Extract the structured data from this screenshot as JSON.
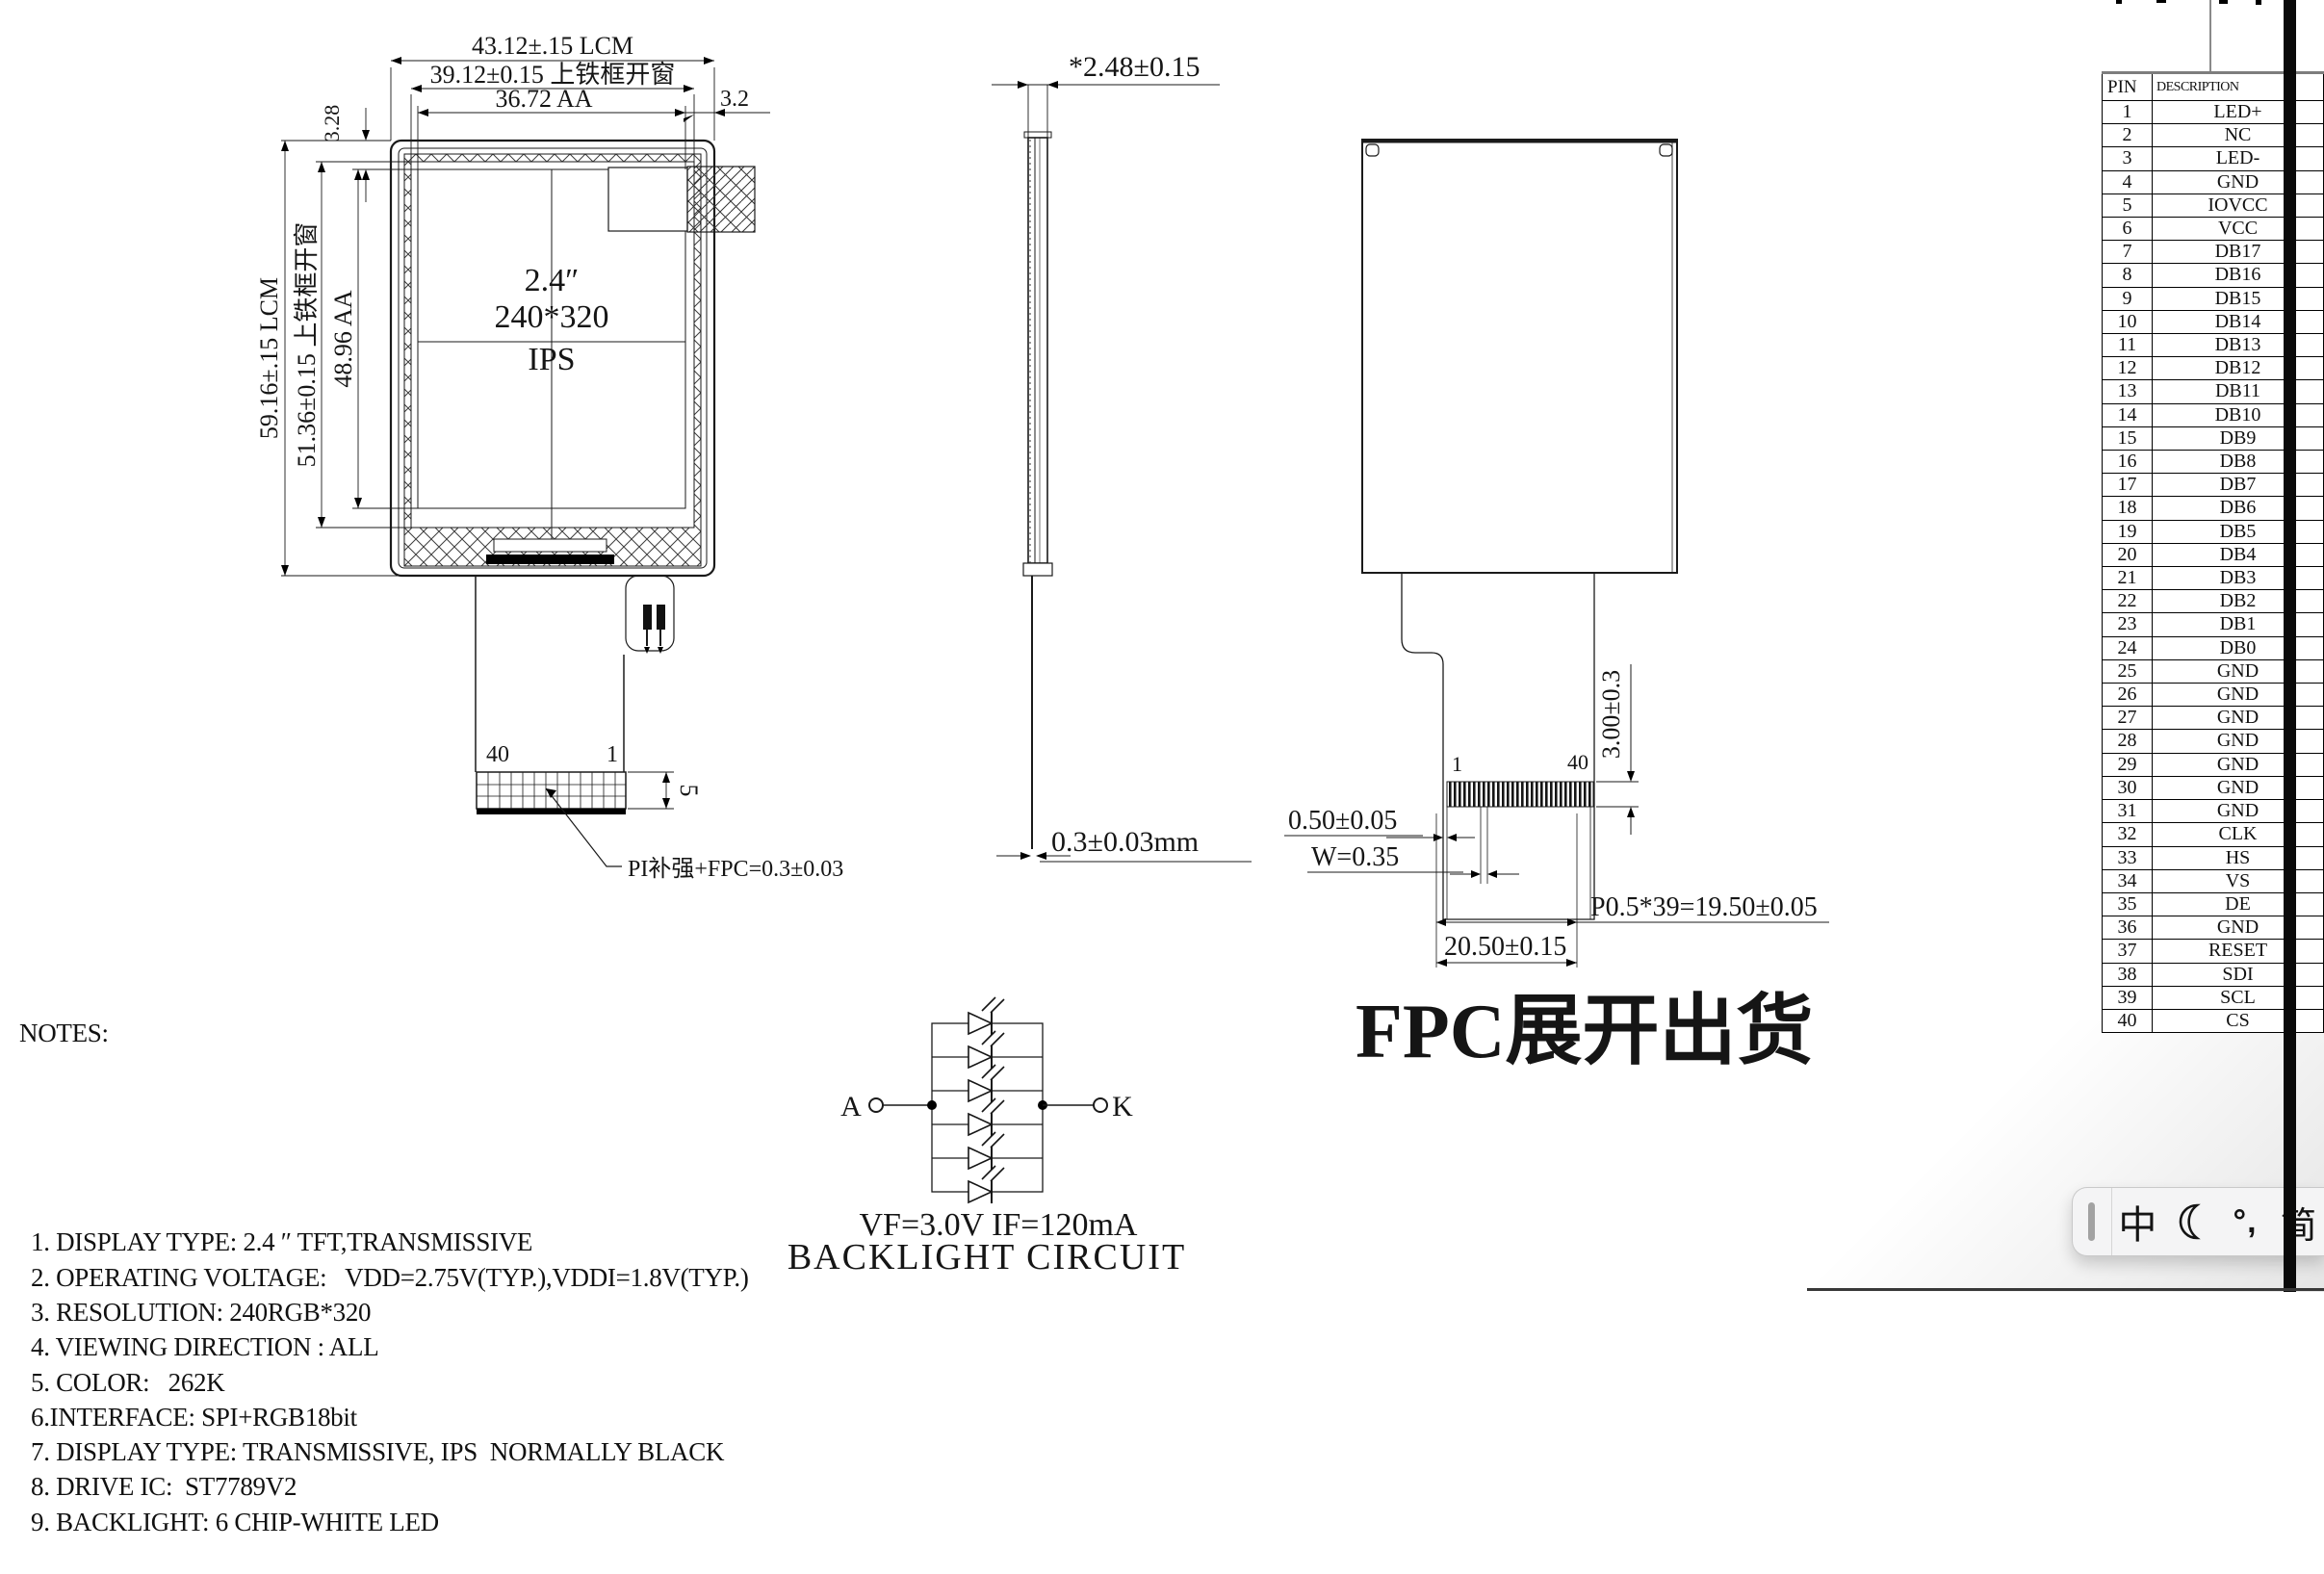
{
  "front_view": {
    "center_line1": "2.4″",
    "center_line2": "240*320",
    "center_line3": "IPS",
    "dim_width_lcm": "43.12±.15 LCM",
    "dim_width_window": "39.12±0.15 上铁框开窗",
    "dim_width_aa": "36.72 AA",
    "dim_gap_right": "3.2",
    "dim_gap_top": "3.28",
    "dim_height_lcm": "59.16±.15 LCM",
    "dim_height_window": "51.36±0.15 上铁框开窗",
    "dim_height_aa": "48.96 AA",
    "pin_left": "40",
    "pin_right": "1",
    "dim_connector": "5",
    "leader_note": "PI补强+FPC=0.3±0.03"
  },
  "side_view": {
    "dim_thickness": "*2.48±0.15",
    "dim_fpc": "0.3±0.03mm"
  },
  "back_view": {
    "pin_first": "1",
    "pin_last": "40",
    "dim_stiffener": "3.00±0.3",
    "dim_offset": "0.50±0.05",
    "dim_pad": "W=0.35",
    "dim_pitch": "P0.5*39=19.50±0.05",
    "dim_width": "20.50±0.15",
    "caption": "FPC展开出货"
  },
  "backlight": {
    "anode": "A",
    "cathode": "K",
    "spec": "VF=3.0V IF=120mA",
    "caption": "BACKLIGHT CIRCUIT"
  },
  "notes": {
    "title": "NOTES:",
    "items": [
      "1. DISPLAY TYPE: 2.4 ″ TFT,TRANSMISSIVE",
      "2. OPERATING VOLTAGE:   VDD=2.75V(TYP.),VDDI=1.8V(TYP.)",
      "3. RESOLUTION: 240RGB*320",
      "4. VIEWING DIRECTION : ALL",
      "5. COLOR:   262K",
      "6.INTERFACE: SPI+RGB18bit",
      "7. DISPLAY TYPE: TRANSMISSIVE, IPS  NORMALLY BLACK",
      "8. DRIVE IC:  ST7789V2",
      "9. BACKLIGHT: 6 CHIP-WHITE LED"
    ]
  },
  "pin_table": {
    "header_pin": "PIN",
    "header_desc": "DESCRIPTION",
    "rows": [
      {
        "pin": "1",
        "desc": "LED+"
      },
      {
        "pin": "2",
        "desc": "NC"
      },
      {
        "pin": "3",
        "desc": "LED-"
      },
      {
        "pin": "4",
        "desc": "GND"
      },
      {
        "pin": "5",
        "desc": "IOVCC"
      },
      {
        "pin": "6",
        "desc": "VCC"
      },
      {
        "pin": "7",
        "desc": "DB17"
      },
      {
        "pin": "8",
        "desc": "DB16"
      },
      {
        "pin": "9",
        "desc": "DB15"
      },
      {
        "pin": "10",
        "desc": "DB14"
      },
      {
        "pin": "11",
        "desc": "DB13"
      },
      {
        "pin": "12",
        "desc": "DB12"
      },
      {
        "pin": "13",
        "desc": "DB11"
      },
      {
        "pin": "14",
        "desc": "DB10"
      },
      {
        "pin": "15",
        "desc": "DB9"
      },
      {
        "pin": "16",
        "desc": "DB8"
      },
      {
        "pin": "17",
        "desc": "DB7"
      },
      {
        "pin": "18",
        "desc": "DB6"
      },
      {
        "pin": "19",
        "desc": "DB5"
      },
      {
        "pin": "20",
        "desc": "DB4"
      },
      {
        "pin": "21",
        "desc": "DB3"
      },
      {
        "pin": "22",
        "desc": "DB2"
      },
      {
        "pin": "23",
        "desc": "DB1"
      },
      {
        "pin": "24",
        "desc": "DB0"
      },
      {
        "pin": "25",
        "desc": "GND"
      },
      {
        "pin": "26",
        "desc": "GND"
      },
      {
        "pin": "27",
        "desc": "GND"
      },
      {
        "pin": "28",
        "desc": "GND"
      },
      {
        "pin": "29",
        "desc": "GND"
      },
      {
        "pin": "30",
        "desc": "GND"
      },
      {
        "pin": "31",
        "desc": "GND"
      },
      {
        "pin": "32",
        "desc": "CLK"
      },
      {
        "pin": "33",
        "desc": "HS"
      },
      {
        "pin": "34",
        "desc": "VS"
      },
      {
        "pin": "35",
        "desc": "DE"
      },
      {
        "pin": "36",
        "desc": "GND"
      },
      {
        "pin": "37",
        "desc": "RESET"
      },
      {
        "pin": "38",
        "desc": "SDI"
      },
      {
        "pin": "39",
        "desc": "SCL"
      },
      {
        "pin": "40",
        "desc": "CS"
      }
    ]
  },
  "ime_bar": {
    "mode": "中",
    "punct": "°,",
    "lang": "简"
  },
  "colors": {
    "line": "#1a1a1a",
    "edge_bar": "#0a0a0a",
    "ime_bg": "#f4f4f5"
  }
}
